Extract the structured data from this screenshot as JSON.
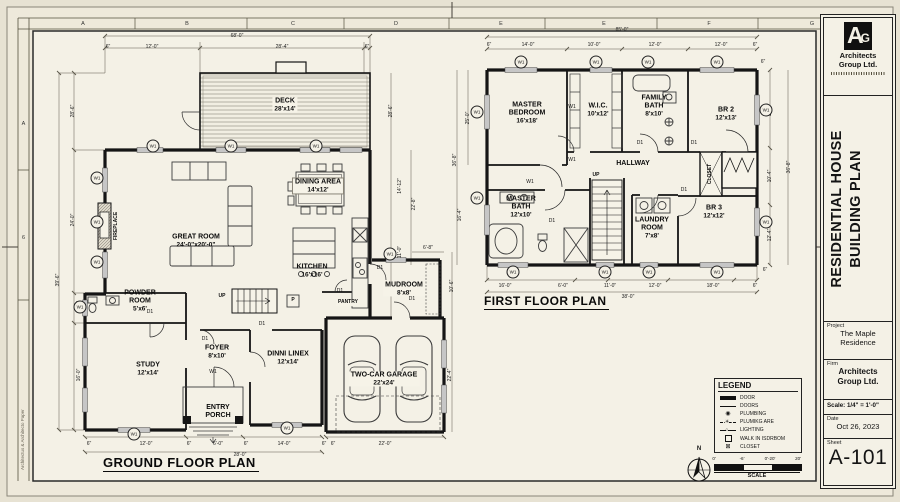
{
  "sheet": {
    "grid_top": [
      "A",
      "B",
      "C",
      "D",
      "E",
      "E",
      "F",
      "G"
    ],
    "grid_left": [
      "A",
      "6"
    ],
    "margin_text": "Architectus & Architecto Paper"
  },
  "title_block": {
    "logo_a": "A",
    "logo_g": "G",
    "logo_firm": "Architects Group Ltd.",
    "drawing_title": "RESIDENTIAL HOUSE BUILDING PLAN",
    "project_label": "Project",
    "project_value": "The Maple Residence",
    "firm_label": "Firm",
    "firm_value": "Architects Group Ltd.",
    "scale_text": "Scale: 1/4\" = 1'-0\"",
    "date_label": "Date",
    "date_value": "Oct 26, 2023",
    "sheet_label": "Sheet",
    "sheet_number": "A-101"
  },
  "plans": {
    "ground": {
      "title": "GROUND FLOOR PLAN"
    },
    "first": {
      "title": "FIRST FLOOR PLAN"
    }
  },
  "rooms": [
    {
      "id": "deck",
      "name": "DECK",
      "size": "28'x14'",
      "x": 285,
      "y": 105,
      "bg": 1
    },
    {
      "id": "great-room",
      "name": "GREAT ROOM",
      "size": "24'-0\"x20'-0\"",
      "x": 196,
      "y": 241
    },
    {
      "id": "dining-area",
      "name": "DINING AREA",
      "size": "14'x12'",
      "x": 318,
      "y": 186,
      "bg": 1,
      "box": 1
    },
    {
      "id": "kitchen",
      "name": "KITCHEN",
      "size": "16'x16'",
      "x": 312,
      "y": 271
    },
    {
      "id": "mudroom",
      "name": "MUDROOM",
      "size": "8'x8'",
      "x": 404,
      "y": 289,
      "bg": 1
    },
    {
      "id": "pantry",
      "name": "PANTRY",
      "x": 348,
      "y": 303,
      "small": 1,
      "bg": 1
    },
    {
      "id": "p-box",
      "name": "P",
      "x": 293,
      "y": 301,
      "small": 1
    },
    {
      "id": "powder-room",
      "name": "POWDER ROOM",
      "size": "5'x6'",
      "x": 140,
      "y": 301,
      "w": 44
    },
    {
      "id": "study",
      "name": "STUDY",
      "size": "12'x14'",
      "x": 148,
      "y": 369
    },
    {
      "id": "foyer",
      "name": "FOYER",
      "size": "8'x10'",
      "x": 217,
      "y": 352
    },
    {
      "id": "entry-porch",
      "name": "ENTRY PORCH",
      "x": 218,
      "y": 412,
      "w": 38
    },
    {
      "id": "dinni-linex",
      "name": "DINNI LINEX",
      "size": "12'x14'",
      "x": 288,
      "y": 358
    },
    {
      "id": "garage",
      "name": "TWO-CAR GARAGE",
      "size": "22'x24'",
      "x": 384,
      "y": 379,
      "bg": 1
    },
    {
      "id": "up-ground",
      "name": "UP",
      "x": 222,
      "y": 297,
      "small": 1
    },
    {
      "id": "fireplace",
      "name": "FIREPLACE",
      "x": 117,
      "y": 226,
      "small": 1,
      "rot": 1
    },
    {
      "id": "master-bedroom",
      "name": "MASTER BEDROOM",
      "size": "16'x18'",
      "x": 527,
      "y": 113,
      "w": 62
    },
    {
      "id": "wic",
      "name": "W.I.C.",
      "size": "10'x12'",
      "x": 598,
      "y": 110
    },
    {
      "id": "family-bath",
      "name": "FAMILY BATH",
      "size": "8'x10'",
      "x": 654,
      "y": 106,
      "w": 42
    },
    {
      "id": "br2",
      "name": "BR 2",
      "size": "12'x13'",
      "x": 726,
      "y": 114
    },
    {
      "id": "hallway",
      "name": "HALLWAY",
      "x": 633,
      "y": 164
    },
    {
      "id": "closet",
      "name": "CLOSET",
      "x": 711,
      "y": 174,
      "small": 1,
      "rot": 1
    },
    {
      "id": "master-bath",
      "name": "MASTER BATH",
      "size": "12'x10'",
      "x": 521,
      "y": 207,
      "w": 50
    },
    {
      "id": "laundry-room",
      "name": "LAUNDRY ROOM",
      "size": "7'x8'",
      "x": 652,
      "y": 228,
      "w": 48
    },
    {
      "id": "br3",
      "name": "BR 3",
      "size": "12'x12'",
      "x": 714,
      "y": 212
    },
    {
      "id": "up-first",
      "name": "UP",
      "x": 596,
      "y": 176,
      "small": 1
    }
  ],
  "dims": [
    [
      "68'-0\"",
      237,
      36
    ],
    [
      "6\"",
      108,
      47
    ],
    [
      "12'-0\"",
      152,
      47
    ],
    [
      "28'-4\"",
      282,
      47
    ],
    [
      "6\"",
      367,
      47
    ],
    [
      "28'-6\"",
      73,
      111,
      1
    ],
    [
      "24'-0\"",
      73,
      220,
      1
    ],
    [
      "9'-6\"",
      79,
      306,
      1
    ],
    [
      "16'-0\"",
      79,
      375,
      1
    ],
    [
      "39'-6\"",
      58,
      280,
      1
    ],
    [
      "28'-6\"",
      391,
      111,
      1
    ],
    [
      "14'-12\"",
      400,
      186,
      1
    ],
    [
      "22'-8\"",
      414,
      204,
      1
    ],
    [
      "11'-0\"",
      400,
      252,
      1
    ],
    [
      "6'-8\"",
      428,
      248
    ],
    [
      "10'-6\"",
      452,
      286,
      1
    ],
    [
      "22'-4\"",
      450,
      375,
      1
    ],
    [
      "6\"",
      89,
      444
    ],
    [
      "12'-0\"",
      146,
      444
    ],
    [
      "6\"",
      189,
      444
    ],
    [
      "6'-0\"",
      218,
      444
    ],
    [
      "6\"",
      246,
      444
    ],
    [
      "14'-0\"",
      284,
      444
    ],
    [
      "6\"",
      324,
      444
    ],
    [
      "28'-0\"",
      240,
      455
    ],
    [
      "6\"",
      333,
      444
    ],
    [
      "22'-0\"",
      385,
      444
    ],
    [
      "85'-0\"",
      622,
      30
    ],
    [
      "6\"",
      489,
      45
    ],
    [
      "14'-0\"",
      528,
      45
    ],
    [
      "10'-0\"",
      594,
      45
    ],
    [
      "12'-0\"",
      655,
      45
    ],
    [
      "12'-0\"",
      721,
      45
    ],
    [
      "6\"",
      755,
      45
    ],
    [
      "25'-0\"",
      468,
      118,
      1
    ],
    [
      "36'-8\"",
      455,
      160,
      1
    ],
    [
      "16'-4\"",
      460,
      215,
      1
    ],
    [
      "6\"",
      763,
      62
    ],
    [
      "13'-6\"",
      770,
      110,
      1
    ],
    [
      "10'-4\"",
      770,
      176,
      1
    ],
    [
      "12'-4\"",
      770,
      235,
      1
    ],
    [
      "36'-8\"",
      789,
      167,
      1
    ],
    [
      "6\"",
      765,
      270
    ],
    [
      "16'-0\"",
      505,
      286
    ],
    [
      "6'-0\"",
      563,
      286
    ],
    [
      "11'-0\"",
      610,
      286
    ],
    [
      "12'-0\"",
      655,
      286
    ],
    [
      "18'-0\"",
      713,
      286
    ],
    [
      "6\"",
      755,
      286
    ],
    [
      "38'-0\"",
      628,
      297
    ]
  ],
  "markers": [
    {
      "t": "W1",
      "x": 153,
      "y": 146,
      "c": 1
    },
    {
      "t": "W1",
      "x": 231,
      "y": 146,
      "c": 1
    },
    {
      "t": "W1",
      "x": 316,
      "y": 146,
      "c": 1
    },
    {
      "t": "W1",
      "x": 97,
      "y": 178,
      "c": 1
    },
    {
      "t": "W1",
      "x": 97,
      "y": 222,
      "c": 1
    },
    {
      "t": "W1",
      "x": 97,
      "y": 262,
      "c": 1
    },
    {
      "t": "W1",
      "x": 80,
      "y": 307,
      "c": 1
    },
    {
      "t": "W1",
      "x": 134,
      "y": 434,
      "c": 1
    },
    {
      "t": "W1",
      "x": 287,
      "y": 428,
      "c": 1
    },
    {
      "t": "W1",
      "x": 390,
      "y": 254,
      "c": 1
    },
    {
      "t": "W1",
      "x": 213,
      "y": 372
    },
    {
      "t": "D1",
      "x": 205,
      "y": 339
    },
    {
      "t": "D1",
      "x": 150,
      "y": 312
    },
    {
      "t": "D1",
      "x": 262,
      "y": 324
    },
    {
      "t": "D1",
      "x": 340,
      "y": 291
    },
    {
      "t": "D1",
      "x": 380,
      "y": 268
    },
    {
      "t": "D1",
      "x": 412,
      "y": 299
    },
    {
      "t": "W1",
      "x": 521,
      "y": 62,
      "c": 1
    },
    {
      "t": "W1",
      "x": 596,
      "y": 62,
      "c": 1
    },
    {
      "t": "W1",
      "x": 648,
      "y": 62,
      "c": 1
    },
    {
      "t": "W1",
      "x": 717,
      "y": 62,
      "c": 1
    },
    {
      "t": "W1",
      "x": 477,
      "y": 112,
      "c": 1
    },
    {
      "t": "W1",
      "x": 477,
      "y": 198,
      "c": 1
    },
    {
      "t": "W1",
      "x": 766,
      "y": 110,
      "c": 1
    },
    {
      "t": "W1",
      "x": 766,
      "y": 222,
      "c": 1
    },
    {
      "t": "W1",
      "x": 513,
      "y": 272,
      "c": 1
    },
    {
      "t": "W1",
      "x": 605,
      "y": 272,
      "c": 1
    },
    {
      "t": "W1",
      "x": 649,
      "y": 272,
      "c": 1
    },
    {
      "t": "W1",
      "x": 717,
      "y": 272,
      "c": 1
    },
    {
      "t": "W1",
      "x": 572,
      "y": 107
    },
    {
      "t": "W1",
      "x": 530,
      "y": 182
    },
    {
      "t": "W1",
      "x": 572,
      "y": 160
    },
    {
      "t": "D1",
      "x": 640,
      "y": 143
    },
    {
      "t": "D1",
      "x": 694,
      "y": 143
    },
    {
      "t": "D1",
      "x": 684,
      "y": 190
    },
    {
      "t": "D1",
      "x": 552,
      "y": 221
    }
  ],
  "legend": {
    "title": "LEGEND",
    "items": [
      {
        "sym": "bar",
        "label": "DOOR"
      },
      {
        "sym": "line",
        "label": "DOORS"
      },
      {
        "sym": "circ",
        "label": "PLUMBING"
      },
      {
        "sym": "star",
        "label": "PLUMIKG ARE"
      },
      {
        "sym": "light",
        "label": "LIGHTING"
      },
      {
        "sym": "sq",
        "label": "WALK IN ISDRBOM"
      },
      {
        "sym": "sqx",
        "label": "CLOSET"
      }
    ]
  },
  "compass": {
    "north_label": "N"
  },
  "scalebar": {
    "ticks": [
      "0'",
      "-6'",
      "0'-20'",
      "20'"
    ],
    "label": "SCALE"
  }
}
